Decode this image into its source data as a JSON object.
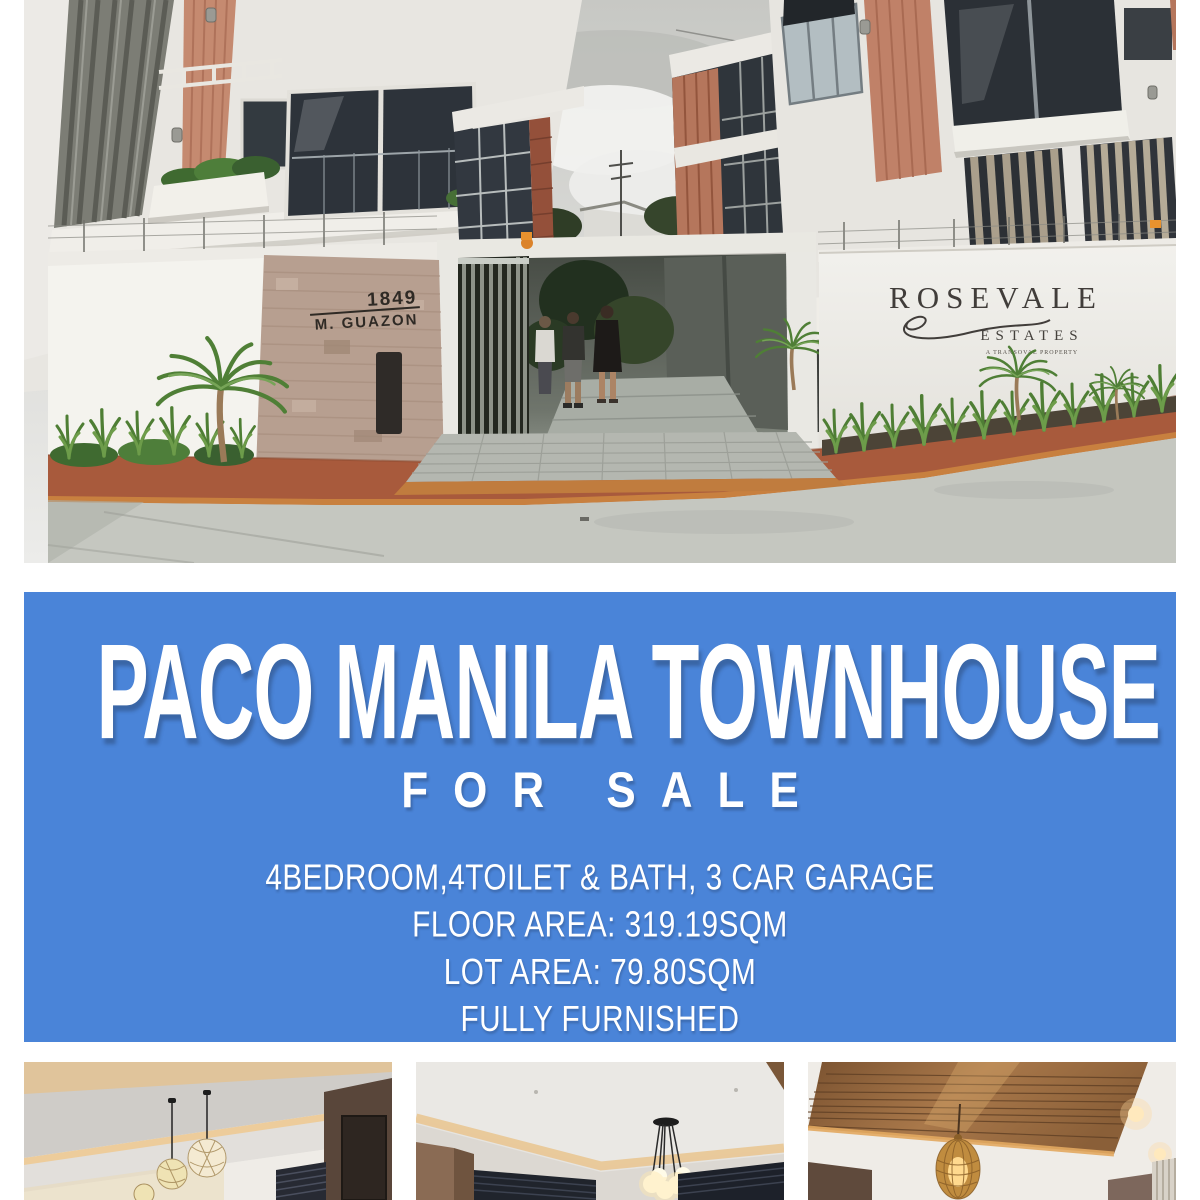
{
  "poster": {
    "background": "#ffffff",
    "accent_blue": "#4a84d8",
    "text_color": "#ffffff"
  },
  "hero": {
    "description": "Wide-angle street photo of a modern townhouse compound entrance with gate, stone pillar, plants and signage",
    "address_sign": {
      "number": "1849",
      "street": "M. GUAZON"
    },
    "estate_sign": {
      "name": "ROSEVALE",
      "word2": "ESTATES",
      "tagline": "A TRANSOVAL PROPERTY"
    }
  },
  "banner": {
    "title": "PACO MANILA TOWNHOUSE",
    "subtitle": "FOR SALE",
    "details": [
      "4BEDROOM,4TOILET & BATH, 3 CAR GARAGE",
      "FLOOR AREA: 319.19SQM",
      "LOT AREA: 79.80SQM",
      "FULLY FURNISHED"
    ]
  },
  "gallery": {
    "photos": [
      {
        "label": "interior-ceiling-living-room-pendants"
      },
      {
        "label": "interior-ceiling-dining-chandelier"
      },
      {
        "label": "interior-wood-plank-ceiling-wicker-pendant"
      }
    ]
  }
}
